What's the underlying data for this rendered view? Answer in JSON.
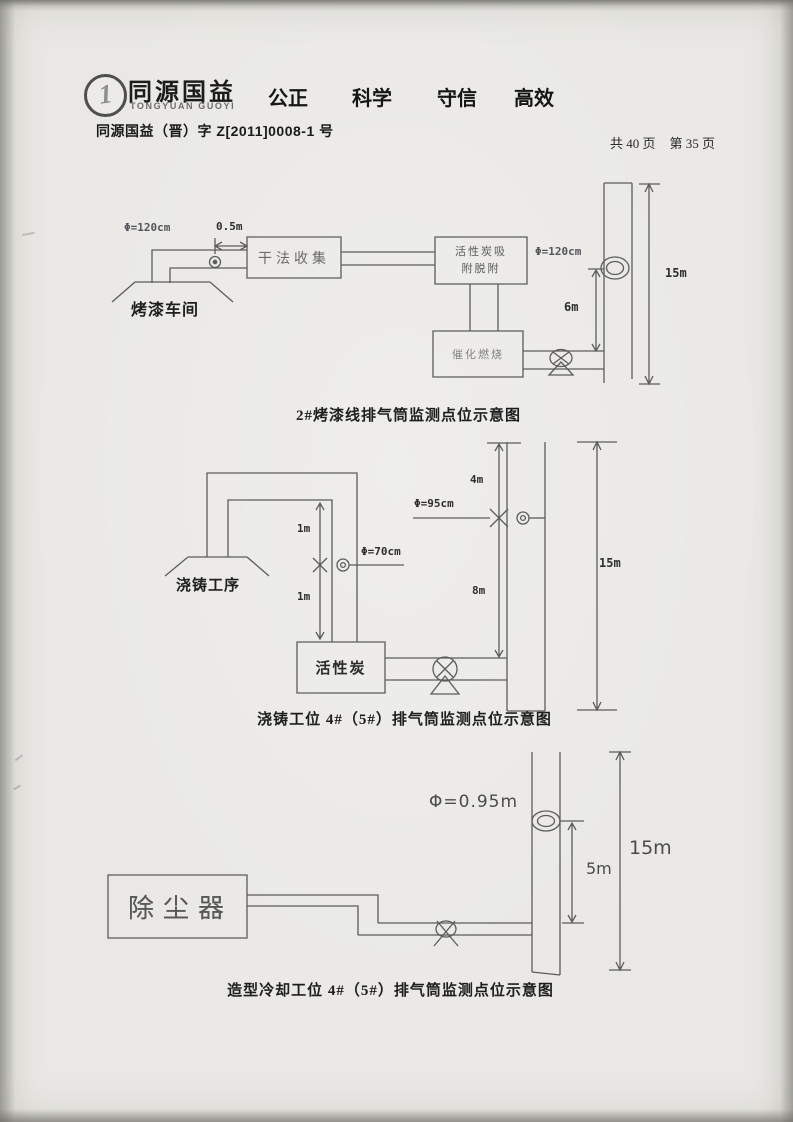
{
  "header": {
    "logo_mark": "1",
    "logo_cn": "同源国益",
    "logo_en": "TONGYUAN GUOYI",
    "slogan": [
      "公正",
      "科学",
      "守信",
      "高效"
    ],
    "doc_number": "同源国益（晋）字 Z[2011]0008-1 号",
    "page_count": "共 40 页",
    "page_current": "第 35 页"
  },
  "diagrams": [
    {
      "caption": "2#烤漆线排气筒监测点位示意图",
      "labels": {
        "duct_diameter": "Φ=120cm",
        "port_offset": "0.5m",
        "source": "烤漆车间",
        "dry_collection": "干法收集",
        "carbon_line1": "活性炭吸",
        "carbon_line2": "附脱附",
        "stack_diameter": "Φ=120cm",
        "catalytic": "催化燃烧",
        "port_height": "6m",
        "stack_height": "15m"
      }
    },
    {
      "caption": "浇铸工位 4#（5#）排气筒监测点位示意图",
      "labels": {
        "source": "浇铸工序",
        "up_dist": "1m",
        "down_dist": "1m",
        "duct_diameter": "Φ=70cm",
        "carbon": "活性炭",
        "top_dist": "4m",
        "stack_diameter": "Φ=95cm",
        "mid_dist": "8m",
        "stack_height": "15m"
      }
    },
    {
      "caption": "造型冷却工位 4#（5#）排气筒监测点位示意图",
      "labels": {
        "source": "除尘器",
        "stack_diameter": "Φ=0.95m",
        "port_height": "5m",
        "stack_height": "15m"
      }
    }
  ]
}
